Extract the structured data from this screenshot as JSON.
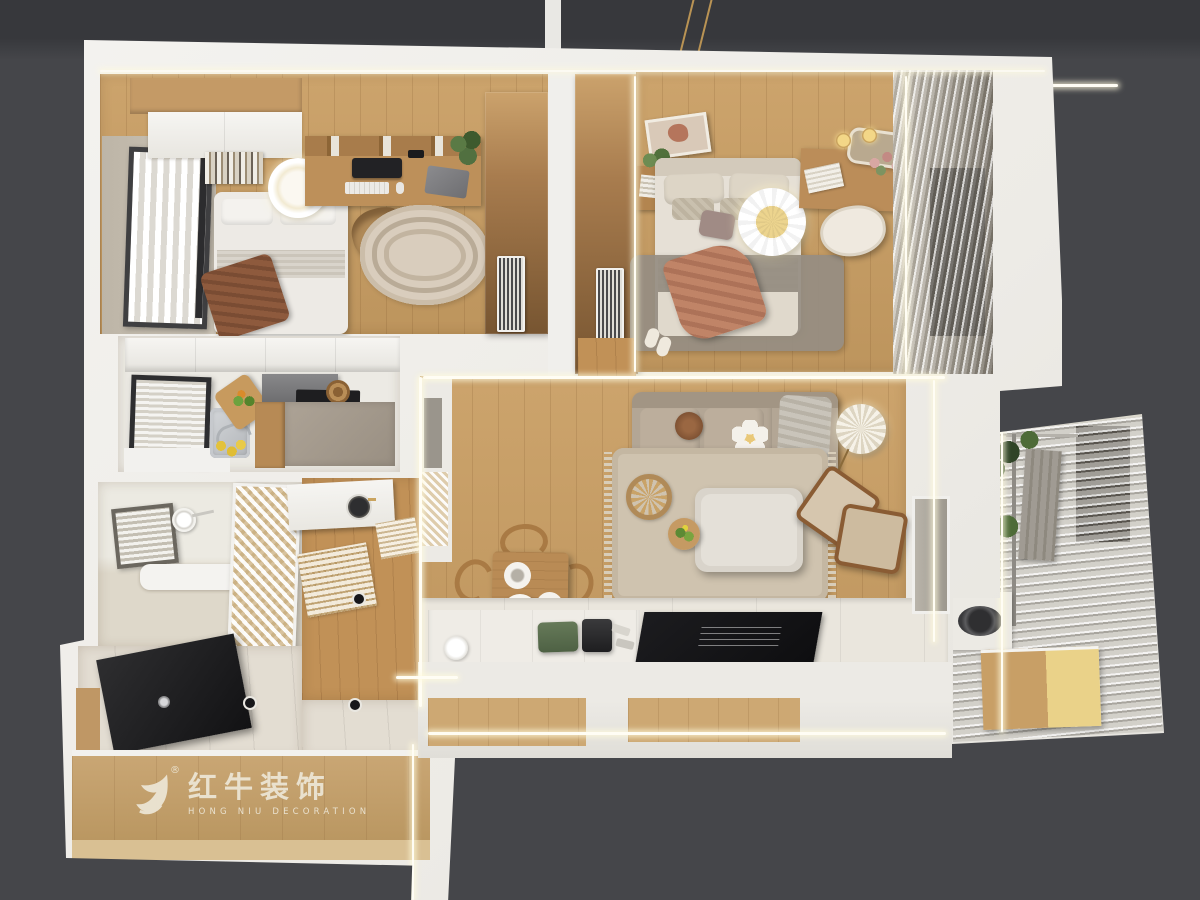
{
  "watermark": {
    "brand_cn": "红牛装饰",
    "brand_en": "HONG NIU DECORATION",
    "registered": "®"
  },
  "palette": {
    "bg": "#45464a",
    "bg-top": "#37383c",
    "wall": "#f1f0ed",
    "wall-shade": "#dcdad4",
    "wood": "#c99e63",
    "wood-hall": "#c19157",
    "wood-dark": "#8a6038",
    "tile": "#e3ddd2",
    "platform": "#eae6dd",
    "greige": "#c9c1b3",
    "sofa": "#b3a695",
    "rug": "#cfc3af",
    "rug-study": "#d9cdbd",
    "black": "#141416",
    "salmon": "#c08467",
    "throw-brown": "#8e5a3d",
    "towel": "#a09b93",
    "green": "#49663a",
    "gold": "#caa45f",
    "glow": "#fffdf4",
    "logo": "#ece5d4",
    "curtain-dark": "#57534d"
  }
}
